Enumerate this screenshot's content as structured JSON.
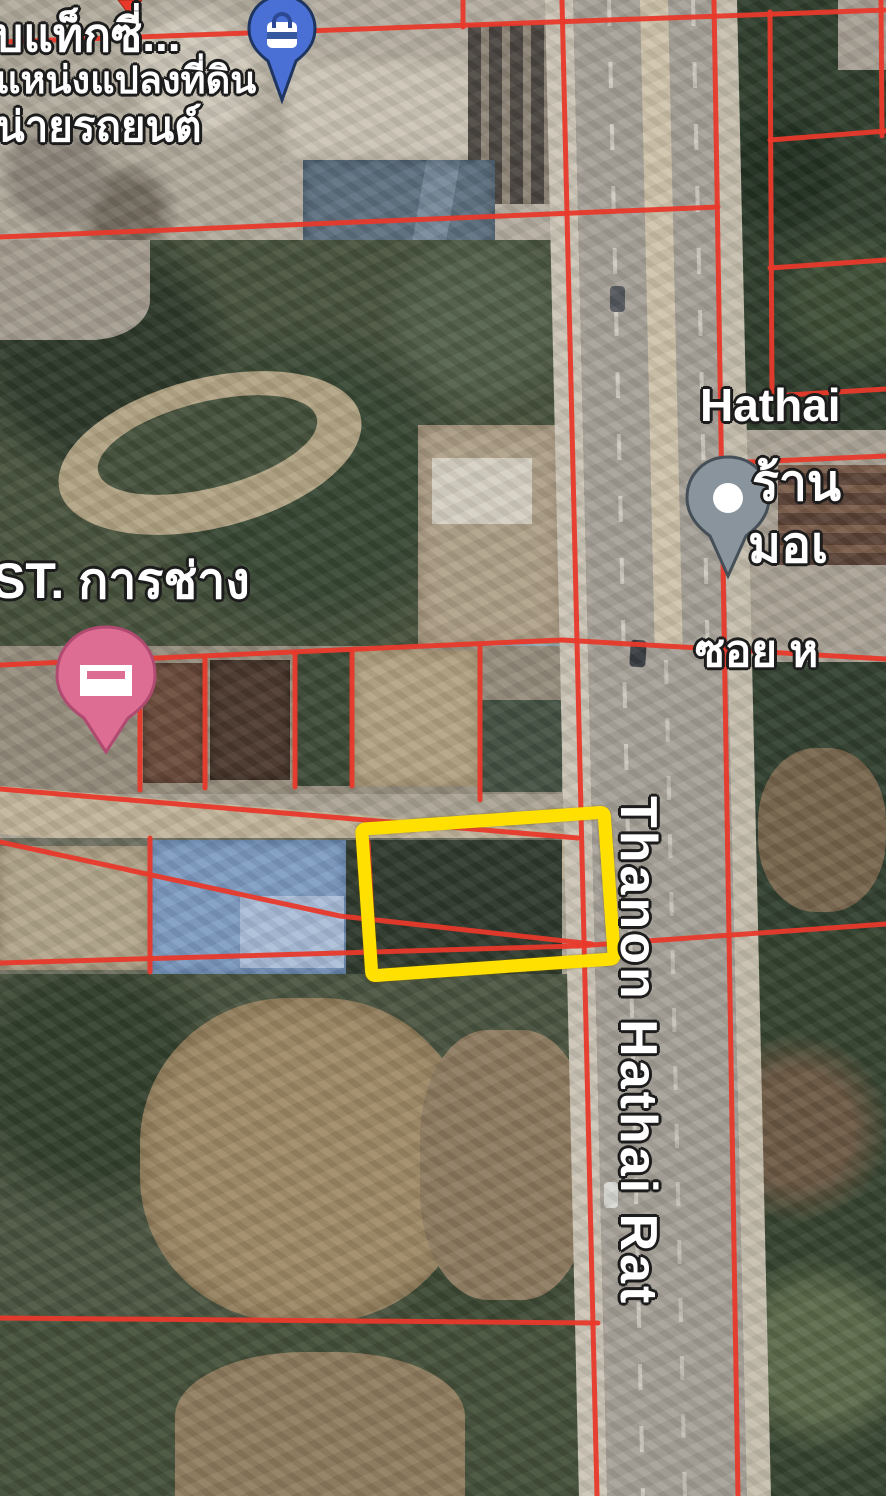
{
  "title": "Satellite map with cadastral parcel overlay",
  "road": {
    "name_label": "Thanon Hathai Rat"
  },
  "labels": {
    "poi_top_line1": "บแท็กซี่...",
    "poi_top_line2": "แหน่งแปลงที่ดิน",
    "poi_top_line3": "น่ายรถยนต์",
    "st_garage": "ST. การช่าง",
    "hathai_partial": "Hathai",
    "shop_line1": "ร้าน",
    "shop_line2": "มอเ",
    "soi_partial": "ซอย ห"
  },
  "pins": {
    "shopping": {
      "icon": "shopping-bag-icon",
      "color": "#4a70d6"
    },
    "lodging": {
      "icon": "bed-icon",
      "color": "#dd6d93"
    },
    "place": {
      "icon": "dot-icon",
      "color": "#8a949c"
    },
    "saved_tip": {
      "icon": "pin-tip-icon",
      "color": "#e8392b"
    }
  },
  "overlay": {
    "parcel_line_color": "#e8392b",
    "plot_highlight_color": "#ffe000"
  }
}
